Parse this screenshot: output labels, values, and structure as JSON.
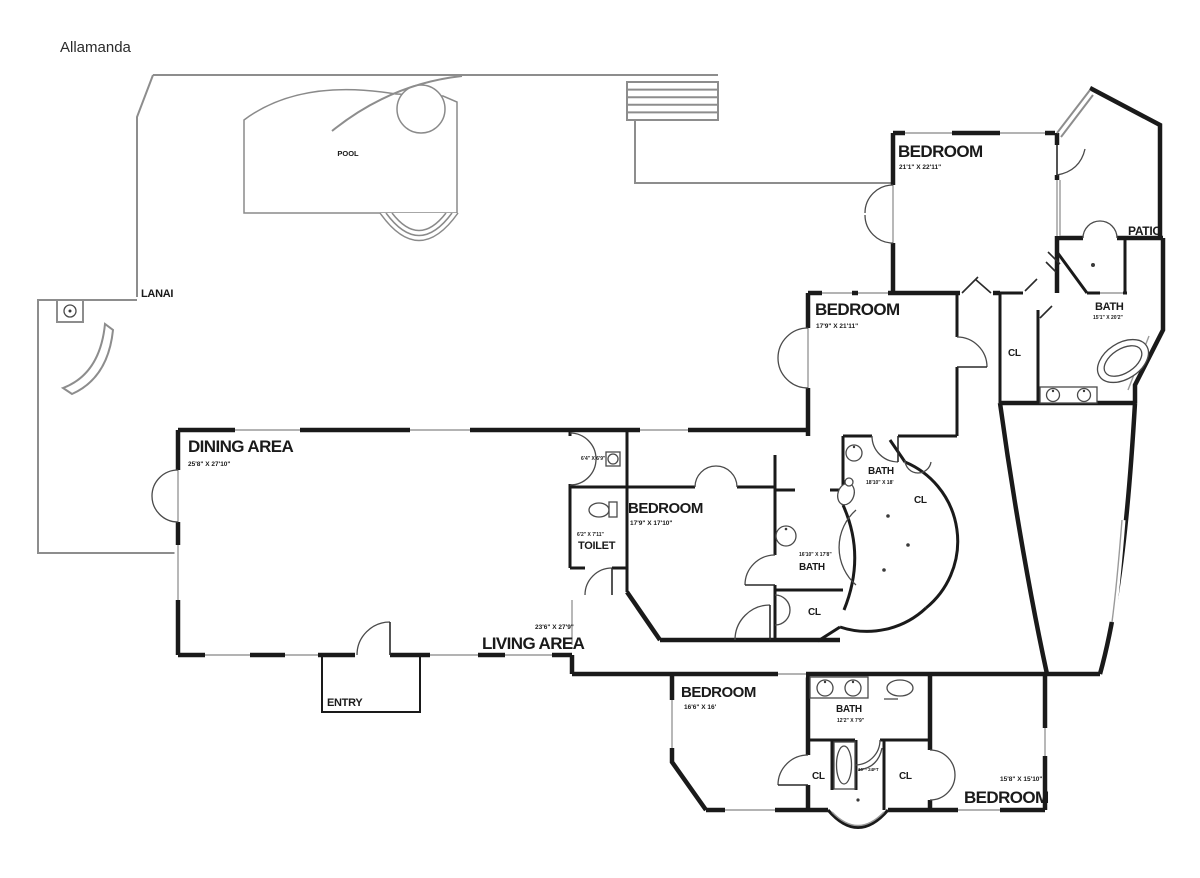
{
  "title": "Allamanda",
  "colors": {
    "wall": "#1a1a1a",
    "deck": "#8d8d8d",
    "door": "#4a4a4a",
    "fixture": "#4a4a4a",
    "text": "#1a1a1a"
  },
  "rooms": {
    "pool": "POOL",
    "lanai": "LANAI",
    "patio": "PATIO",
    "entry": "ENTRY",
    "closet": "CL",
    "dining": {
      "name": "DINING AREA",
      "dims": "25'8\" X 27'10\""
    },
    "living": {
      "name": "LIVING AREA",
      "dims": "23'6\" X 27'9\""
    },
    "toilet": {
      "name": "TOILET",
      "dims": "6'2\" X 7'11\""
    },
    "storage": {
      "dims": "6'4\" X 6'9\""
    },
    "bedroom_ne": {
      "name": "BEDROOM",
      "dims": "21'1\" X 22'11\""
    },
    "bedroom_e": {
      "name": "BEDROOM",
      "dims": "17'9\" X 21'11\""
    },
    "bedroom_c": {
      "name": "BEDROOM",
      "dims": "17'9\" X 17'10\""
    },
    "bedroom_s": {
      "name": "BEDROOM",
      "dims": "16'6\" X 16'"
    },
    "bedroom_se": {
      "name": "BEDROOM",
      "dims": "15'8\" X 15'10\""
    },
    "bath_master": {
      "name": "BATH",
      "dims": "15'1\" X 20'2\""
    },
    "bath_n": {
      "name": "BATH",
      "dims": "18'10\" X 18'"
    },
    "bath_w": {
      "name": "BATH",
      "dims": "16'10\" X 17'8\""
    },
    "bath_s": {
      "name": "BATH",
      "dims": "12'2\" X 7'9\""
    },
    "tub_note": "10' - 24FT"
  }
}
